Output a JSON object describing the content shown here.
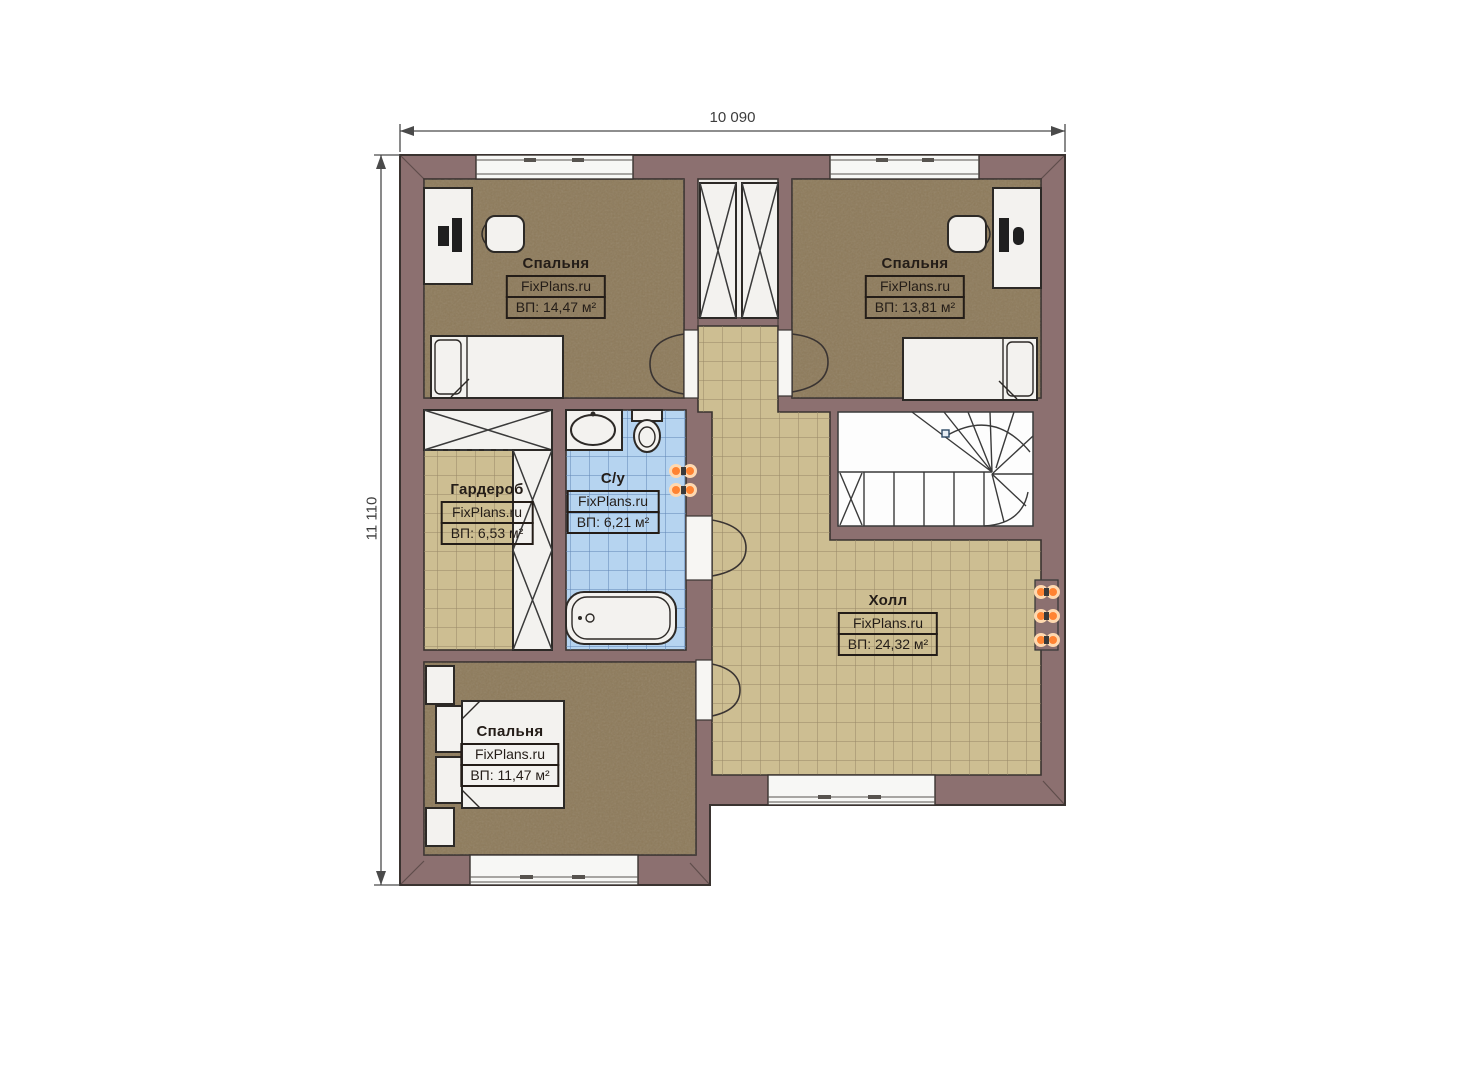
{
  "dimensions": {
    "top": "10 090",
    "left": "11 110"
  },
  "rooms": {
    "bedroom_top_left": {
      "name": "Спальня",
      "brand": "FixPlans.ru",
      "area": "ВП: 14,47 м²"
    },
    "bedroom_top_right": {
      "name": "Спальня",
      "brand": "FixPlans.ru",
      "area": "ВП: 13,81 м²"
    },
    "wardrobe": {
      "name": "Гардероб",
      "brand": "FixPlans.ru",
      "area": "ВП: 6,53 м²"
    },
    "bathroom": {
      "name": "С/у",
      "brand": "FixPlans.ru",
      "area": "ВП: 6,21 м²"
    },
    "hall": {
      "name": "Холл",
      "brand": "FixPlans.ru",
      "area": "ВП: 24,32 м²"
    },
    "bedroom_bottom": {
      "name": "Спальня",
      "brand": "FixPlans.ru",
      "area": "ВП: 11,47 м²"
    }
  },
  "colors": {
    "wall": "#8c7070",
    "wall_outline": "#3a3330",
    "bedroom_floor": "#8d7a5a",
    "tile_floor": "#cdbe92",
    "tile_line": "#968766",
    "bath_floor": "#b6d4f0",
    "bath_line": "#5f84b4",
    "furniture": "#f3f2ef",
    "stairs": "#fdfdfd",
    "radiator": "#ff8332",
    "label_text": "#241d18",
    "dimension_text": "#3d3d3d"
  }
}
